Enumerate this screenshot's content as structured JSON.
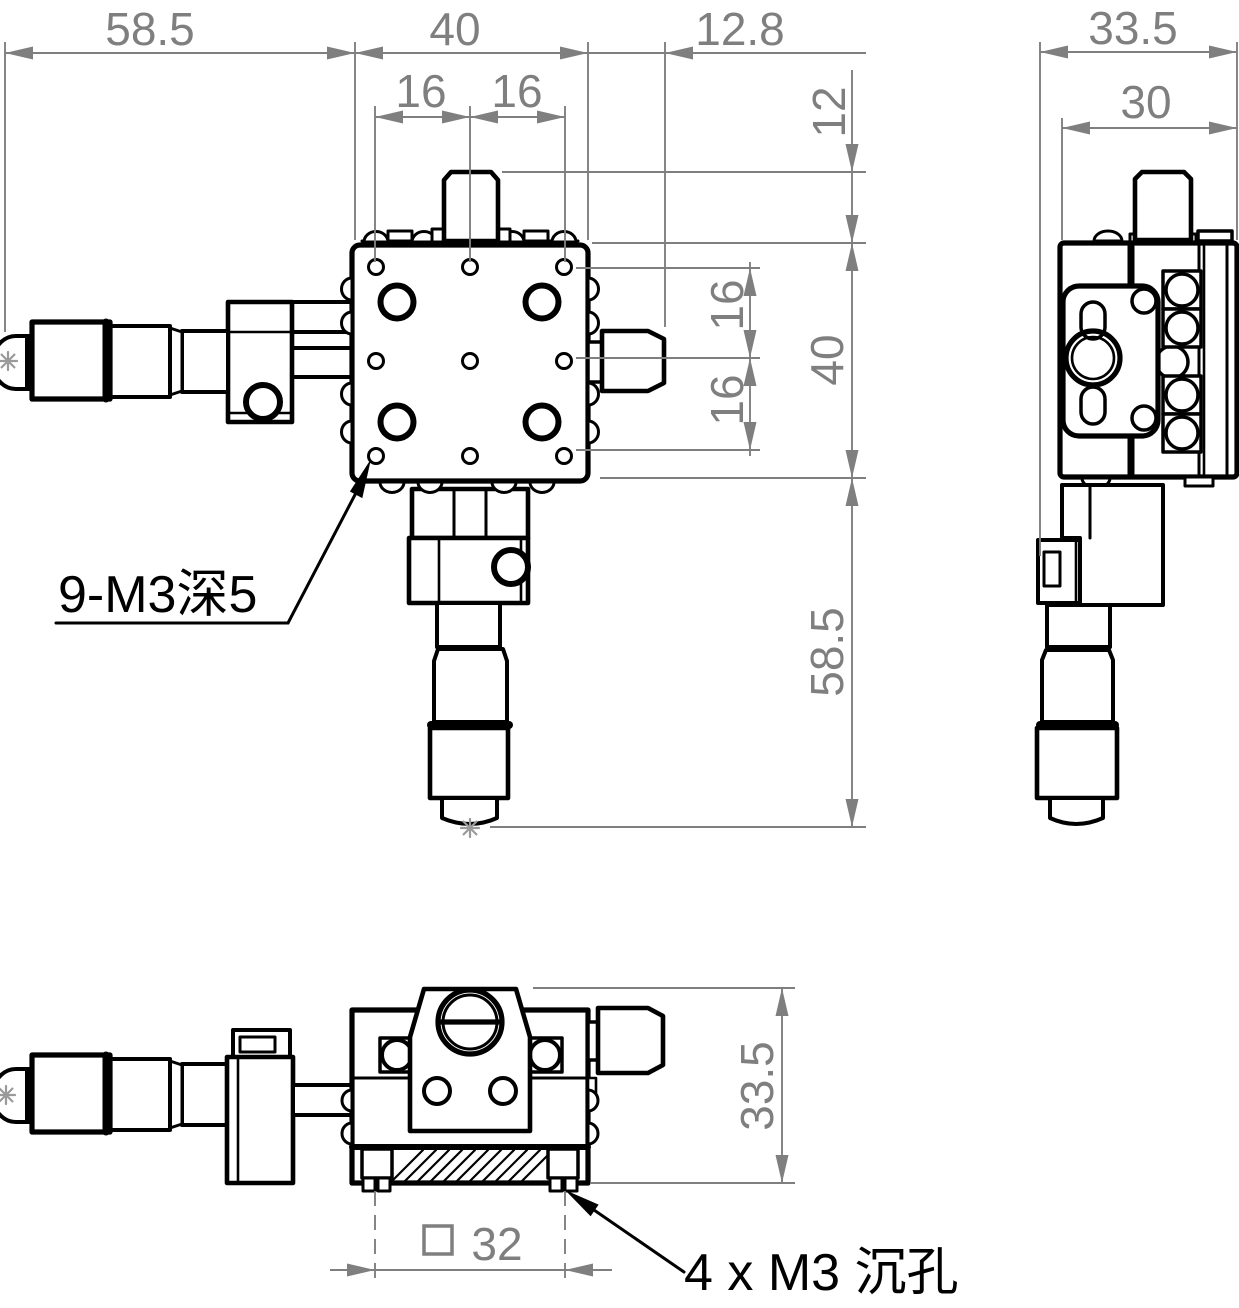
{
  "drawing": {
    "kind": "mechanical-dimension-drawing",
    "subject": "XYZ micrometer translation stage, three orthographic views",
    "colors": {
      "line": "#000000",
      "dimension": "#7f7f7f",
      "background": "#ffffff"
    },
    "dims": {
      "front_top_total": "58.5",
      "front_top_body": "40",
      "front_top_knob": "12.8",
      "front_top_pitch_left": "16",
      "front_top_pitch_right": "16",
      "front_right_knob_height": "12",
      "front_right_pitch_upper": "16",
      "front_right_pitch_lower": "16",
      "front_right_body": "40",
      "front_right_micrometer": "58.5",
      "side_total": "33.5",
      "side_inner": "30",
      "bottom_height": "33.5",
      "bottom_square_symbol": "□",
      "bottom_square_value": "32"
    },
    "notes": {
      "thread_note": "9-M3深5",
      "counterbore_note": "4 x M3 沉孔"
    }
  }
}
